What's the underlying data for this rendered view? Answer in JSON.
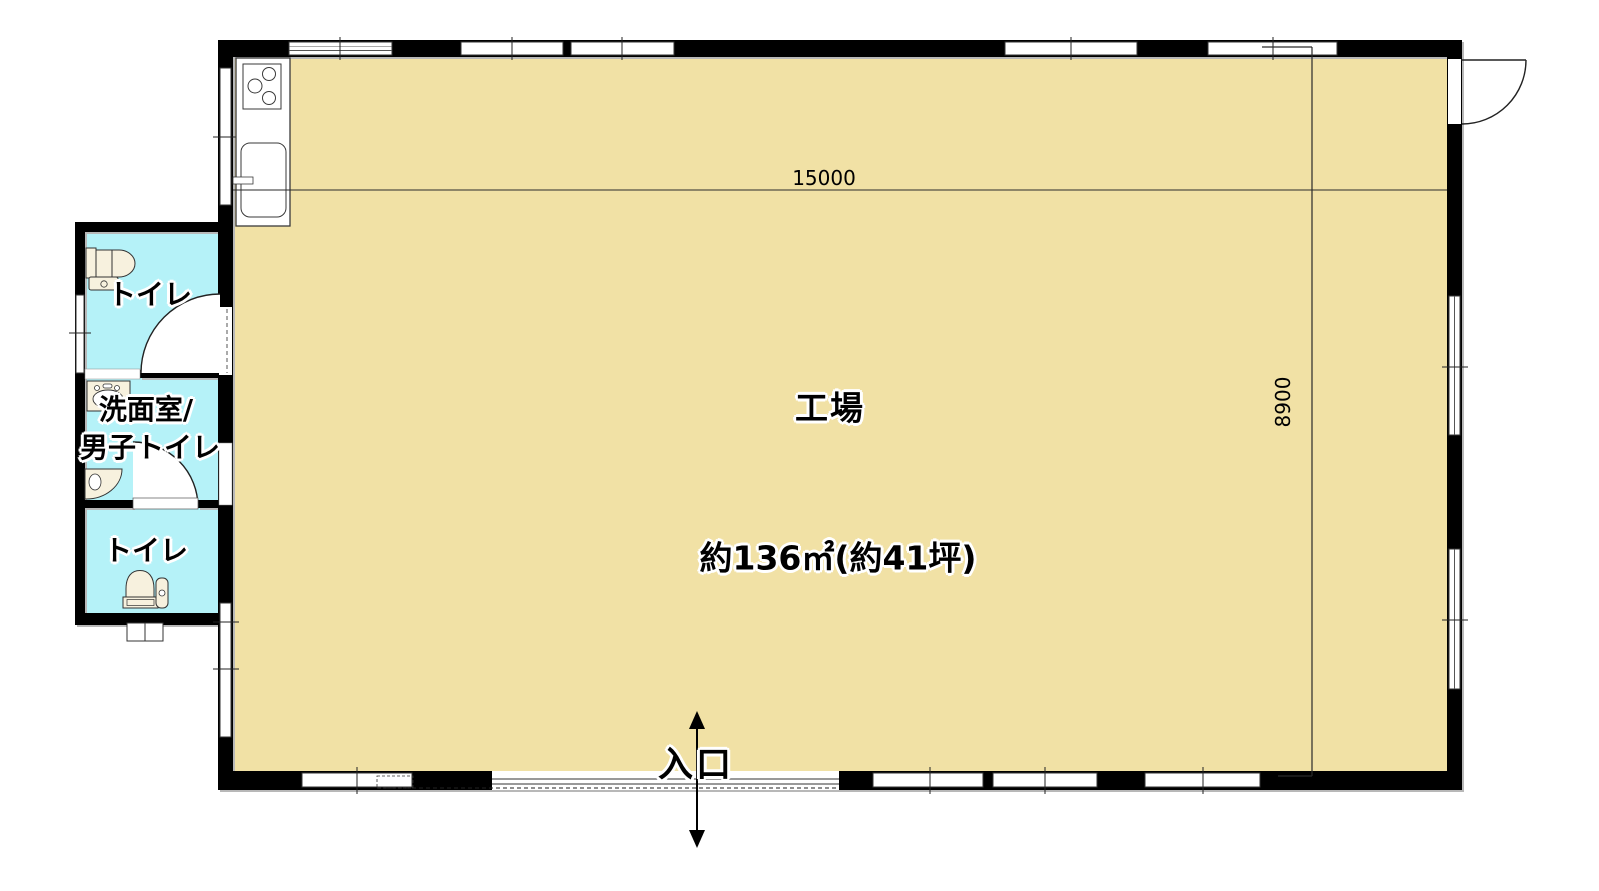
{
  "floorplan": {
    "main_room": {
      "name": "工場",
      "area": "約136㎡(約41坪)"
    },
    "annex_rooms": [
      {
        "name": "トイレ",
        "fixtures": [
          "toilet"
        ]
      },
      {
        "name": "洗面室/男子トイレ",
        "line1": "洗面室/",
        "line2": "男子トイレ",
        "fixtures": [
          "wash-basin",
          "urinal"
        ]
      },
      {
        "name": "トイレ",
        "fixtures": [
          "toilet"
        ]
      }
    ],
    "kitchen_fixtures": [
      "stove",
      "kitchen-sink"
    ],
    "entrance": {
      "label": "入口"
    },
    "dimensions": {
      "width": "15000",
      "depth": "8900"
    },
    "colors": {
      "main_floor": "#f1e1a5",
      "wet_floor": "#b5f2f8",
      "wall": "#000000",
      "fixture": "#f7f1de"
    }
  }
}
